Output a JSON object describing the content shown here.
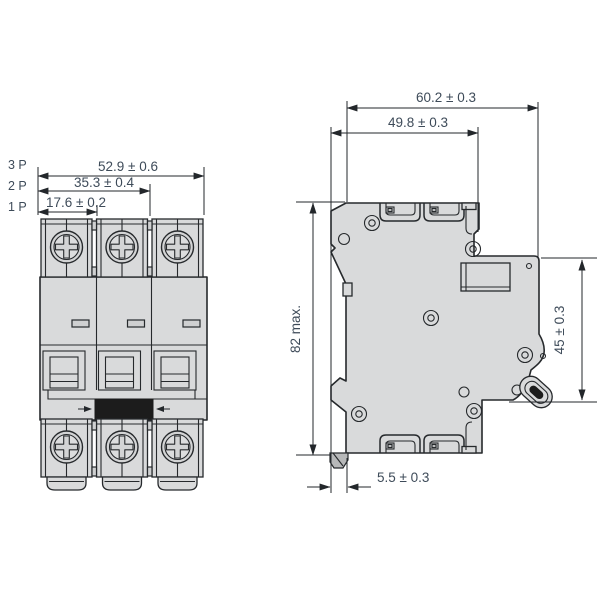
{
  "drawing": {
    "type": "dimensional-technical-drawing",
    "subject": "miniature-circuit-breaker",
    "front_view": {
      "pole_labels": [
        {
          "label": "3 P"
        },
        {
          "label": "2 P"
        },
        {
          "label": "1 P"
        }
      ],
      "dimensions": {
        "width_3p": "52.9 ± 0.6",
        "width_2p": "35.3 ± 0.4",
        "width_1p": "17.6 ± 0.2"
      }
    },
    "side_view": {
      "dimensions": {
        "total_depth": "60.2 ± 0.3",
        "body_depth": "49.8 ± 0.3",
        "height": "82 max.",
        "front_height": "45 ± 0.3",
        "rail_clip_offset": "5.5 ± 0.3"
      }
    },
    "colors": {
      "body_fill": "#d9dadb",
      "body_fill_dark": "#cfd0d1",
      "outline": "#26292c",
      "dimension_text": "#3e4b59",
      "toggle_black": "#1c1c1c",
      "background": "#ffffff"
    }
  }
}
